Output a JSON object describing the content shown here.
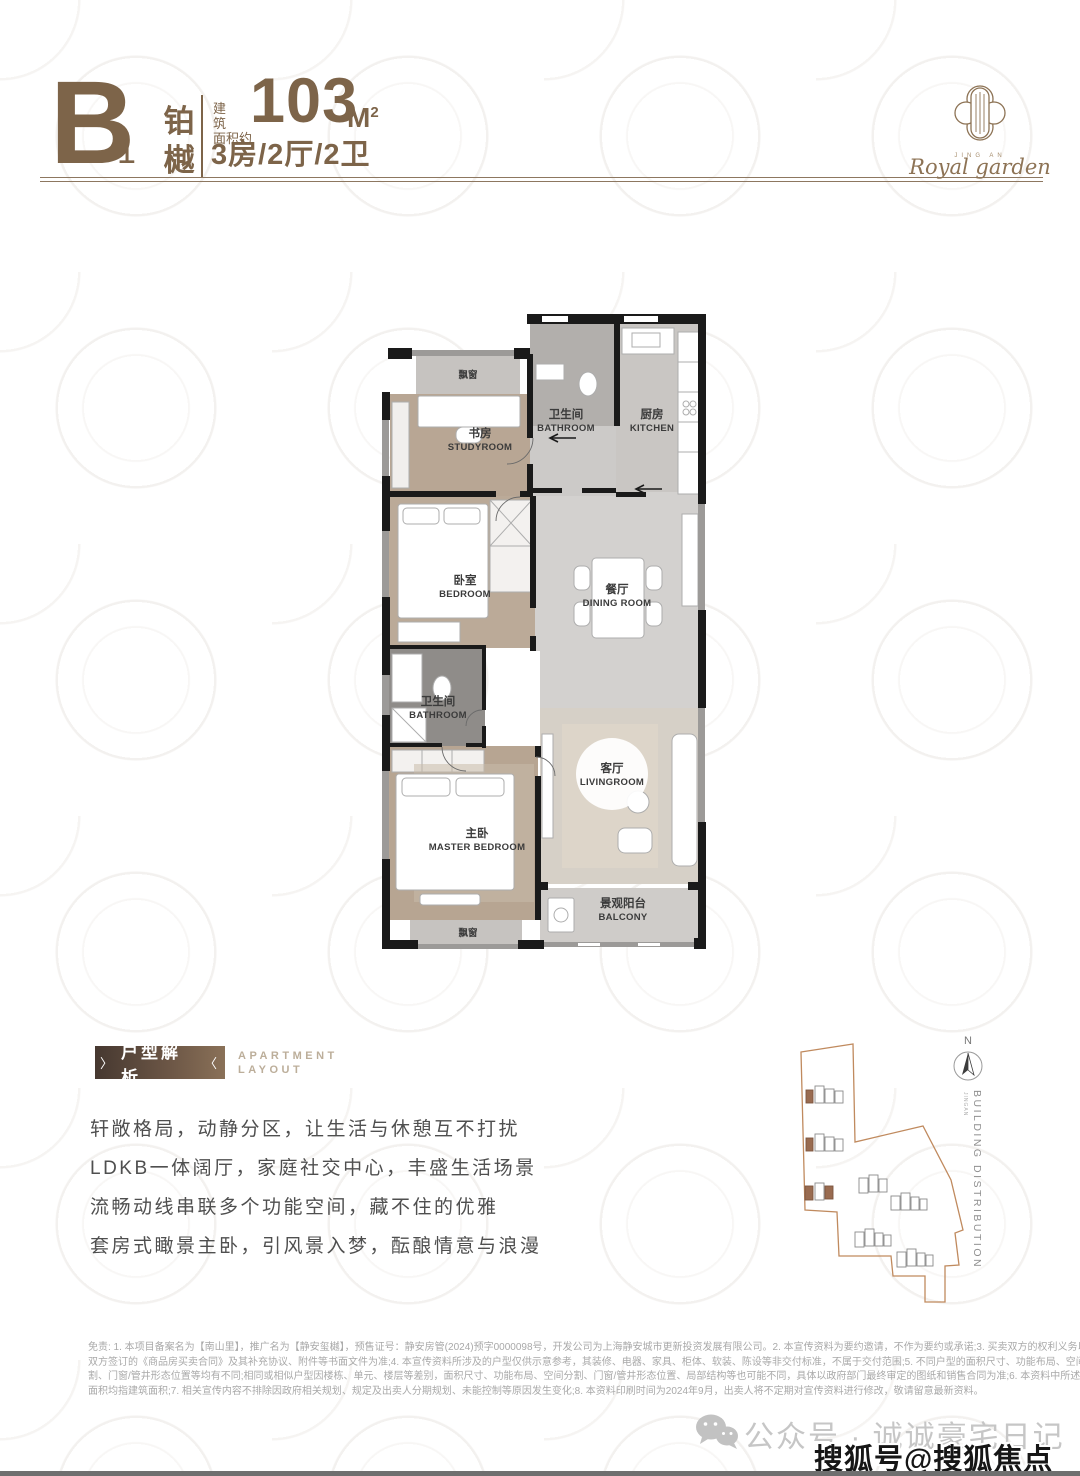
{
  "header": {
    "letter": "B",
    "number": "1",
    "name1": "铂",
    "name2": "樾",
    "area_l1": "建筑",
    "area_l2": "面积约",
    "area_value": "103",
    "area_unit": "M",
    "area_sup": "2",
    "spec": "3房/2厅/2卫"
  },
  "logo": {
    "small": "JING AN",
    "script": "Royal garden"
  },
  "floorplan": {
    "rooms": [
      {
        "cn": "飘窗",
        "en": ""
      },
      {
        "cn": "书房",
        "en": "STUDYROOM"
      },
      {
        "cn": "卫生间",
        "en": "BATHROOM"
      },
      {
        "cn": "厨房",
        "en": "KITCHEN"
      },
      {
        "cn": "卧室",
        "en": "BEDROOM"
      },
      {
        "cn": "餐厅",
        "en": "DINING ROOM"
      },
      {
        "cn": "卫生间",
        "en": "BATHROOM"
      },
      {
        "cn": "主卧",
        "en": "MASTER BEDROOM"
      },
      {
        "cn": "客厅",
        "en": "LIVINGROOM"
      },
      {
        "cn": "景观阳台",
        "en": "BALCONY"
      },
      {
        "cn": "飘窗",
        "en": ""
      }
    ]
  },
  "analysis": {
    "badge": "户型解析",
    "chev_left": "〉",
    "chev_right": "〈",
    "en1": "APARTMENT",
    "en2": "LAYOUT",
    "lines": [
      "轩敞格局，动静分区，让生活与休憩互不打扰",
      "LDKB一体阔厅，家庭社交中心，丰盛生活场景",
      "流畅动线串联多个功能空间，藏不住的优雅",
      "套房式瞰景主卧，引风景入梦，酝酿情意与浪漫"
    ]
  },
  "siteplan": {
    "north": "N",
    "caption": "BUILDING DISTRIBUTION",
    "caption_small": "JINGAN"
  },
  "disclaimer": {
    "lines": [
      "免责: 1. 本项目备案名为【南山里】，推广名为【静安玺樾】，预售证号：静安房管(2024)预字0000098号，开发公司为上海静安城市更新投资发展有限公司。2. 本宣传资料为要约邀请，不作为要约或承诺;3. 买卖双方的权利义务以",
      "双方签订的《商品房买卖合同》及其补充协议、附件等书面文件为准;4. 本宣传资料所涉及的户型仅供示意参考，其装修、电器、家具、柜体、软装、陈设等非交付标准，不属于交付范围;5. 不同户型的面积尺寸、功能布局、空间分",
      "割、门窗/管井形态位置等均有不同;相同或相似户型因楼栋、单元、楼层等差别，面积尺寸、功能布局、空间分割、门窗/管井形态位置、局部结构等也可能不同，具体以政府部门最终审定的图纸和销售合同为准;6. 本资料中所述",
      "面积均指建筑面积;7. 相关宣传内容不排除因政府相关规划、规定及出卖人分期规划、未能控制等原因发生变化;8. 本资料印刷时间为2024年9月，出卖人将不定期对宣传资料进行修改，敬请留意最新资料。"
    ]
  },
  "footer": {
    "wechat": "公众号 · 诚诚豪宅日记",
    "watermark": "搜狐号@搜狐焦点淮南站"
  },
  "colors": {
    "brand_brown": "#7d6449",
    "light_brown": "#bcae9a",
    "boundary_orange": "#c08a5e",
    "wall_black": "#1a1a1a",
    "wood_floor": "#b8a694",
    "marble_grey": "#d3d1cf",
    "watermark_text": "#161616",
    "wechat_grey": "#c6c6c6"
  }
}
